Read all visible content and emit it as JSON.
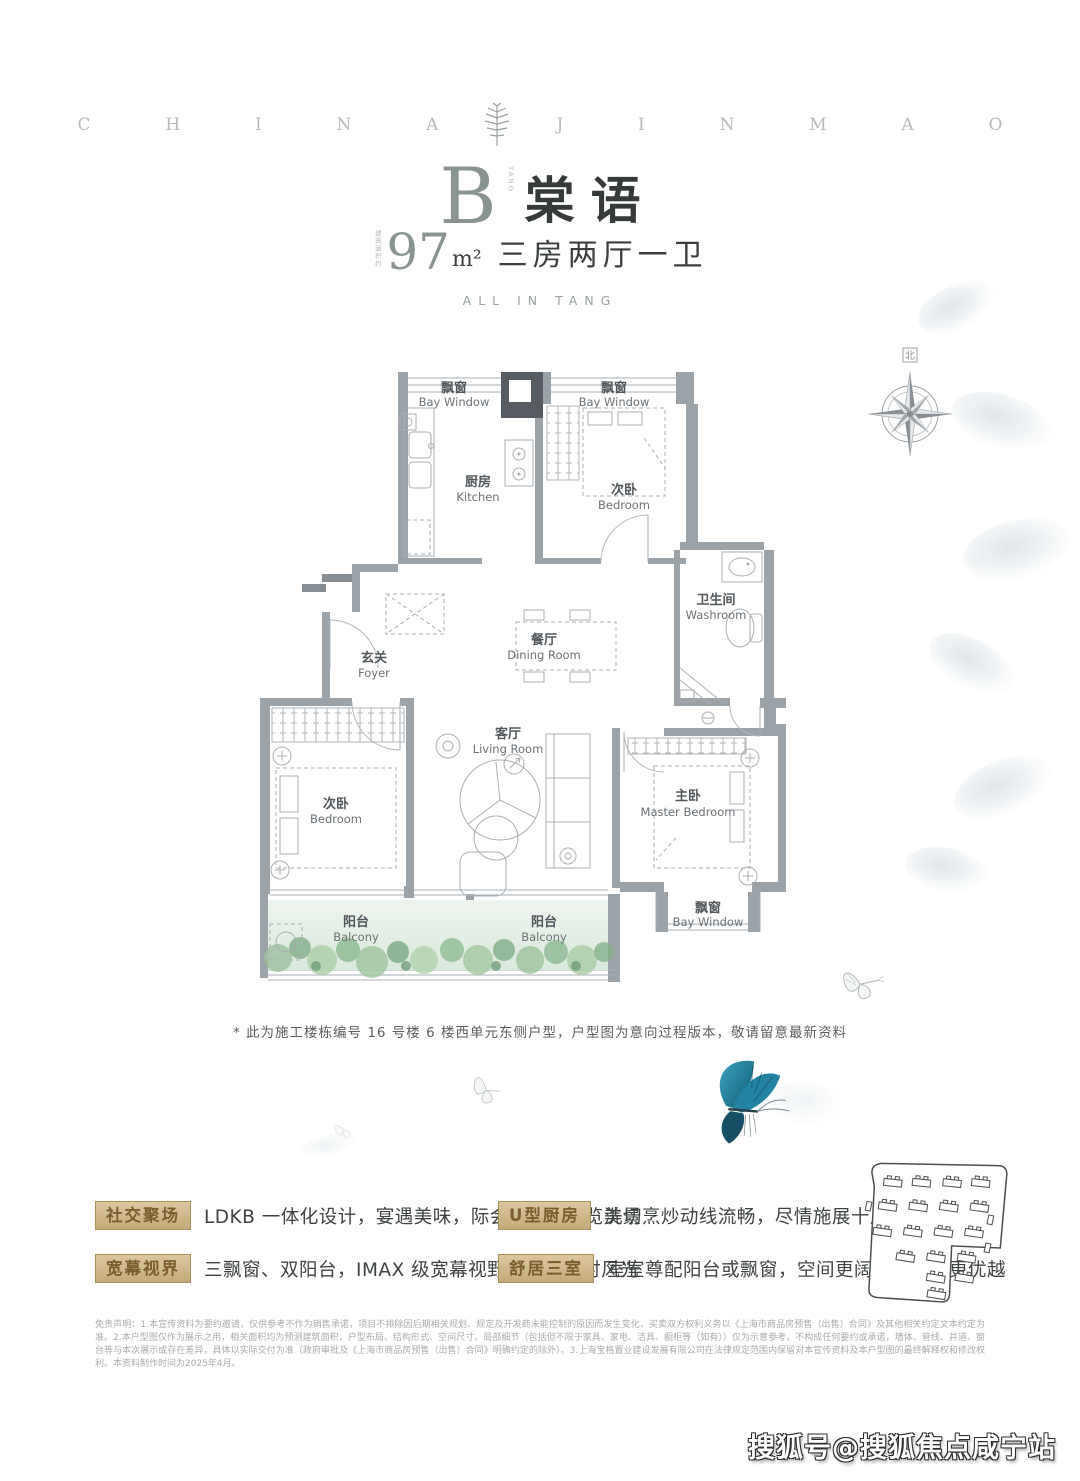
{
  "header": {
    "brand_left": "CHINA",
    "brand_right": "JINMAO"
  },
  "title": {
    "letter": "B",
    "letter_note": "TANG",
    "name": "棠语",
    "area_label": "建筑面积约",
    "area_value": "97",
    "area_unit": "m²",
    "rooms_text": "三房两厅一卫",
    "subtitle_en": "ALL IN TANG"
  },
  "plan": {
    "compass_label": "北",
    "rooms": {
      "bay_top_left": {
        "zh": "飘窗",
        "en": "Bay Window"
      },
      "bay_top_right": {
        "zh": "飘窗",
        "en": "Bay Window"
      },
      "kitchen": {
        "zh": "厨房",
        "en": "Kitchen"
      },
      "bedroom_top": {
        "zh": "次卧",
        "en": "Bedroom"
      },
      "washroom": {
        "zh": "卫生间",
        "en": "Washroom"
      },
      "dining": {
        "zh": "餐厅",
        "en": "Dining Room"
      },
      "foyer": {
        "zh": "玄关",
        "en": "Foyer"
      },
      "living": {
        "zh": "客厅",
        "en": "Living Room"
      },
      "bedroom_left": {
        "zh": "次卧",
        "en": "Bedroom"
      },
      "master": {
        "zh": "主卧",
        "en": "Master Bedroom"
      },
      "balcony_left": {
        "zh": "阳台",
        "en": "Balcony"
      },
      "balcony_right": {
        "zh": "阳台",
        "en": "Balcony"
      },
      "bay_bottom": {
        "zh": "飘窗",
        "en": "Bay Window"
      }
    },
    "note": "* 此为施工楼栋编号 16 号楼 6 楼西单元东侧户型，户型图为意向过程版本，敬请留意最新资料"
  },
  "features": [
    {
      "badge": "社交聚场",
      "text": "LDKB 一体化设计，宴遇美味，际会美好，尽览美景"
    },
    {
      "badge": "宽幕视界",
      "text": "三飘窗、双阳台，IMAX 级宽幕视野，俯赏四时风光"
    },
    {
      "badge": "U型厨房",
      "text": "洗切烹炒动线流畅，尽情施展十八般厨艺"
    },
    {
      "badge": "舒居三室",
      "text": "室室尊配阳台或飘窗，空间更阔绰，视野更优越"
    }
  ],
  "disclaimer": "免责声明：1.本宣传资料为要约邀请，仅供参考不作为销售承诺，项目不排除因后期相关规划、规定及开发商未能控制的原因而发生变化，买卖双方权利义务以《上海市商品房预售（出售）合同》及其他相关约定文本约定为准。2.本户型图仅作为展示之用，相关面积均为预测建筑面积，户型布局、结构形式、空间尺寸、局部细节（包括但不限于家具、家电、洁具、橱柜等（如有））仅为示意参考，不构成任何要约或承诺，墙体、管线、井道、窗台等与本次展示或存在差异，具体以实际交付为准（政府审批及《上海市商品房预售（出售）合同》明确约定的除外）。3.上海宝格置业建设发展有限公司在法律规定范围内保留对本宣传资料及本户型图的最终解释权和修改权利。本资料制作时间为2025年4月。",
  "watermark": "搜狐号@搜狐焦点咸宁站",
  "colors": {
    "badge_text": "#7b5d31",
    "badge_bg": "#d0b588",
    "butterfly_blue": "#2a8dab",
    "wall_gray": "#9ba2a8",
    "title_dark": "#363b3a",
    "title_light": "#8a948f"
  }
}
